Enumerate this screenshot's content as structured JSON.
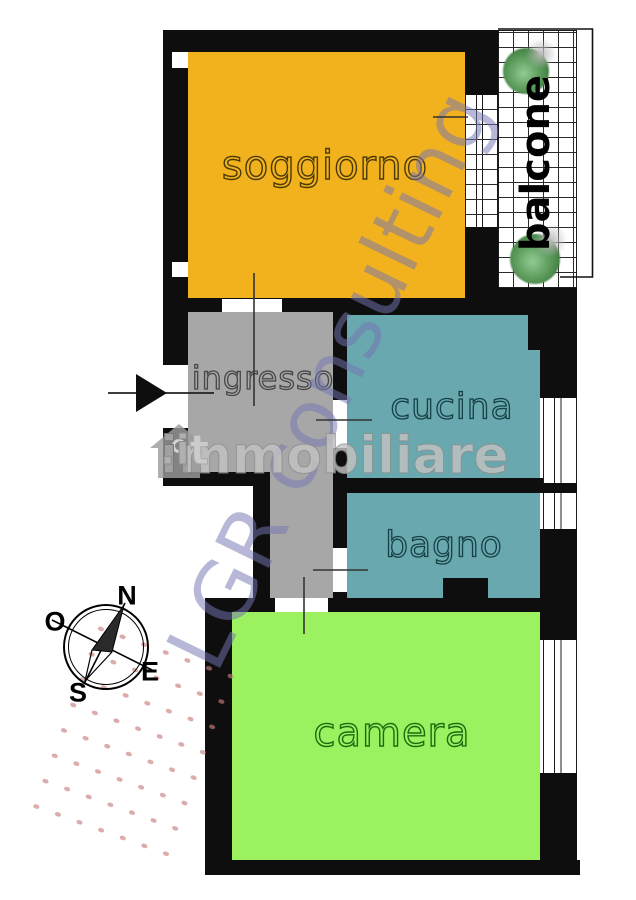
{
  "plan": {
    "type": "apartment floor plan",
    "wall_color": "#0e0e0e",
    "background": "#ffffff"
  },
  "rooms": {
    "soggiorno": {
      "label": "soggiorno",
      "color": "#F2B21D"
    },
    "ingresso": {
      "label": "ingresso",
      "color": "#A7A7A7"
    },
    "cucina": {
      "label": "cucina",
      "color": "#69A8AE"
    },
    "bagno": {
      "label": "bagno",
      "color": "#69A8AE"
    },
    "camera": {
      "label": "camera",
      "color": "#9BF15F"
    },
    "balcone": {
      "label": "balcone",
      "color": "#FFFFFF"
    }
  },
  "compass": {
    "north": "N",
    "south": "S",
    "east": "E",
    "west": "O"
  },
  "watermarks": {
    "brand": "LGR consulting",
    "brand_color": "#7474B2",
    "portal_name": "immobiliare",
    "portal_tld": ".it",
    "portal_color": "#C2C2C2"
  }
}
